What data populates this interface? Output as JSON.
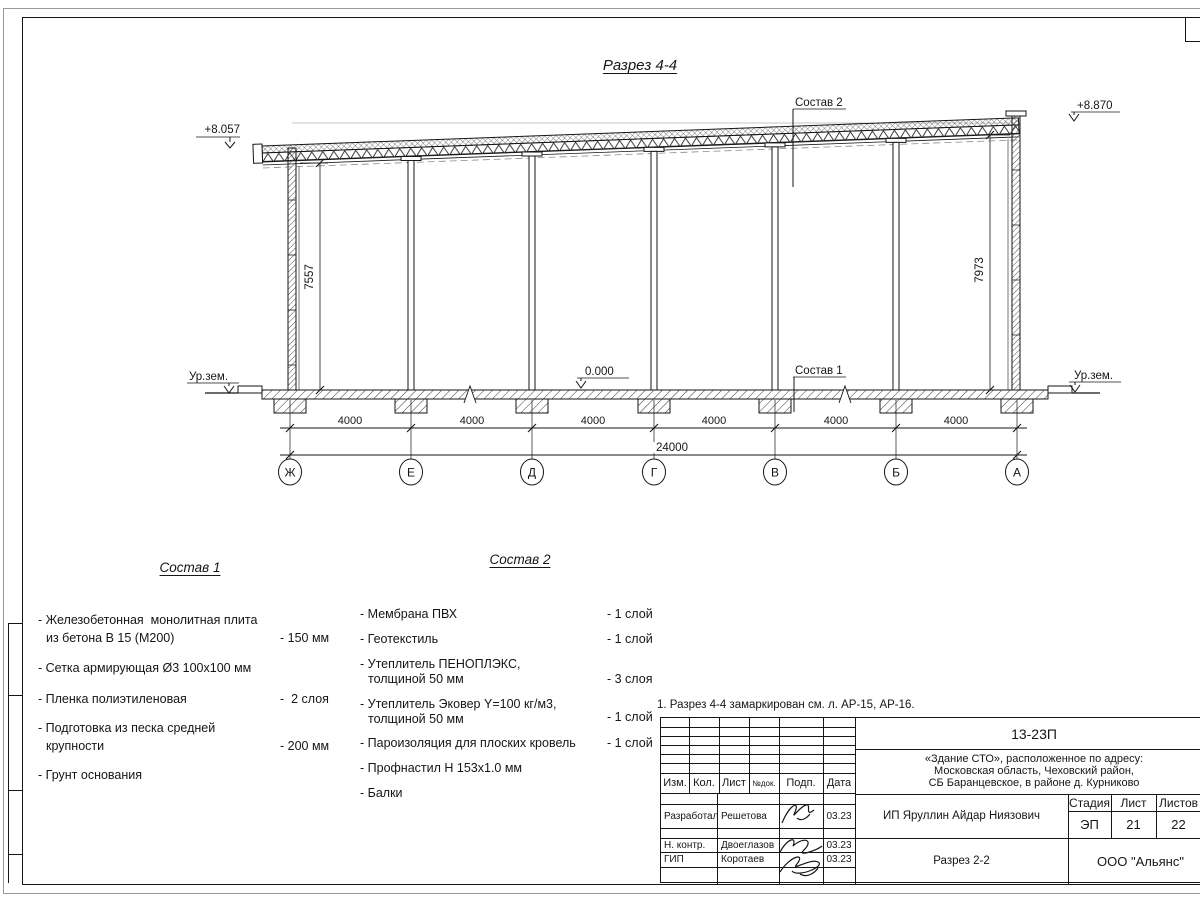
{
  "drawing": {
    "title": "Разрез 4-4",
    "elev_left": "+8.057",
    "elev_right": "+8.870",
    "elev_zero": "0.000",
    "ground_left": "Ур.зем.",
    "ground_right": "Ур.зем.",
    "dim_left": "7557",
    "dim_right": "7973",
    "leader_roof": "Состав 2",
    "leader_floor": "Состав 1",
    "span_dims": [
      "4000",
      "4000",
      "4000",
      "4000",
      "4000",
      "4000"
    ],
    "total_dim": "24000",
    "grid_labels": [
      "Ж",
      "Е",
      "Д",
      "Г",
      "В",
      "Б",
      "А"
    ]
  },
  "comp1": {
    "heading": "Состав 1",
    "items": [
      {
        "lines": [
          "- Железобетонная  монолитная плита",
          "из бетона В 15 (М200)"
        ],
        "value": "- 150 мм"
      },
      {
        "lines": [
          "- Сетка армирующая Ø3 100х100 мм"
        ],
        "value": ""
      },
      {
        "lines": [
          "- Пленка полиэтиленовая"
        ],
        "value": "-  2 слоя"
      },
      {
        "lines": [
          "- Подготовка из песка средней",
          "крупности"
        ],
        "value": "- 200 мм"
      },
      {
        "lines": [
          "- Грунт основания"
        ],
        "value": ""
      }
    ]
  },
  "comp2": {
    "heading": "Состав 2",
    "items": [
      {
        "lines": [
          "- Мембрана ПВХ"
        ],
        "value": "- 1 слой"
      },
      {
        "lines": [
          "- Геотекстиль"
        ],
        "value": "- 1 слой"
      },
      {
        "lines": [
          "- Утеплитель ПЕНОПЛЭКС,",
          "толщиной 50 мм"
        ],
        "value": "- 3 слоя"
      },
      {
        "lines": [
          "- Утеплитель Эковер Y=100 кг/м3,",
          "толщиной 50 мм"
        ],
        "value": "- 1 слой"
      },
      {
        "lines": [
          "- Пароизоляция для плоских кровель"
        ],
        "value": "- 1 слой"
      },
      {
        "lines": [
          "- Профнастил Н 153х1.0 мм"
        ],
        "value": ""
      },
      {
        "lines": [
          "- Балки"
        ],
        "value": ""
      }
    ]
  },
  "note": "1. Разрез 4-4 замаркирован см. л. АР-15, АР-16.",
  "titleblock": {
    "doc_number": "13-23П",
    "project_lines": [
      "«Здание СТО», расположенное по адресу:",
      "Московская область, Чеховский район,",
      "СБ Баранцевское, в районе д. Курниково"
    ],
    "header_cols": [
      "Изм.",
      "Кол.",
      "Лист",
      "№док.",
      "Подп.",
      "Дата"
    ],
    "rows": [
      {
        "role": "Разработал",
        "name": "Решетова",
        "date": "03.23"
      },
      {
        "role": "Н. контр.",
        "name": "Двоеглазов",
        "date": "03.23"
      },
      {
        "role": "ГИП",
        "name": "Коротаев",
        "date": "03.23"
      }
    ],
    "client": "ИП Яруллин Айдар Ниязович",
    "sheet_title": "Разрез 2-2",
    "stage_label": "Стадия",
    "sheet_label": "Лист",
    "sheets_label": "Листов",
    "stage": "ЭП",
    "sheet_no": "21",
    "sheets_total": "22",
    "company": "ООО \"Альянс\""
  }
}
